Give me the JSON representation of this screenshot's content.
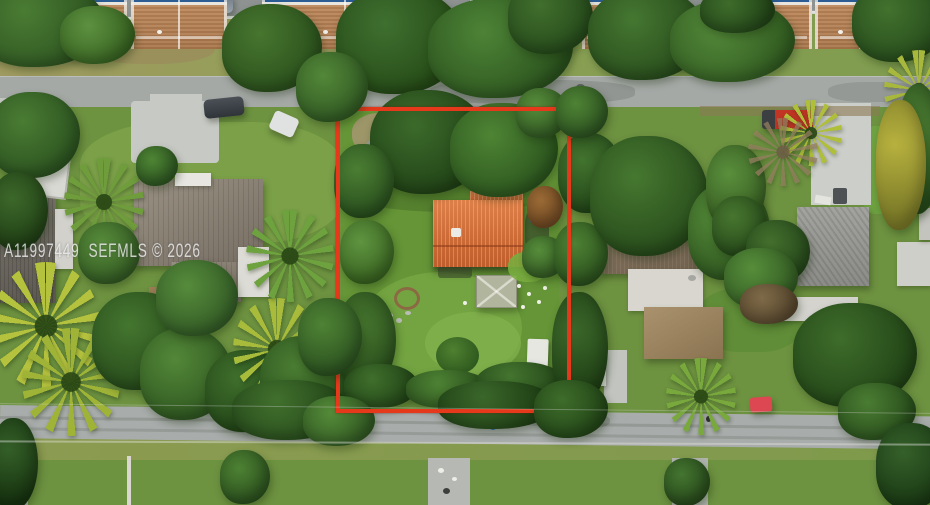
{
  "watermark": {
    "text": "A11997449  SEFMLS © 2026"
  },
  "colors": {
    "boundary_outline": "#e6391c",
    "subject_roof_orange": "#cf6c3a",
    "townhouse_roof_tan": "#bf8a5d",
    "asphalt_road": "#a5a9a6",
    "lawn_green": "#6d9240",
    "watermark_text": "rgba(245,245,245,0.78)"
  }
}
